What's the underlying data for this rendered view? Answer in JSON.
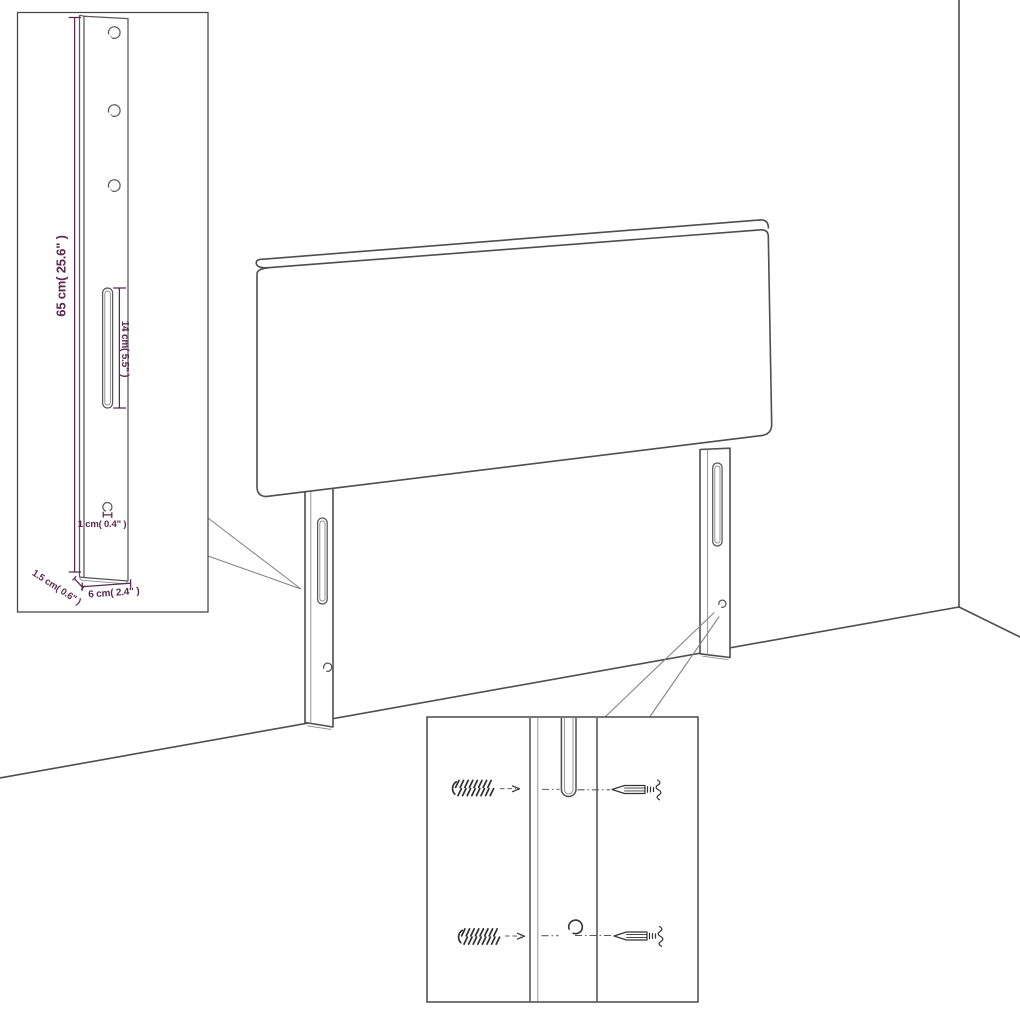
{
  "colors": {
    "background": "#ffffff",
    "outline": "#4e4e4e",
    "detail": "#8f8f8f",
    "callout_line": "#848484",
    "hardware": "#333333",
    "dimension": "#5c2751"
  },
  "dimension_inset": {
    "height_label": "65 cm( 25.6\" )",
    "slot_length_label": "14 cm( 5.5\" )",
    "hole_diameter_label": "1 cm( 0.4\" )",
    "thickness_label": "1.5 cm( 0.6\" )",
    "width_label": "6 cm( 2.4\" )"
  }
}
